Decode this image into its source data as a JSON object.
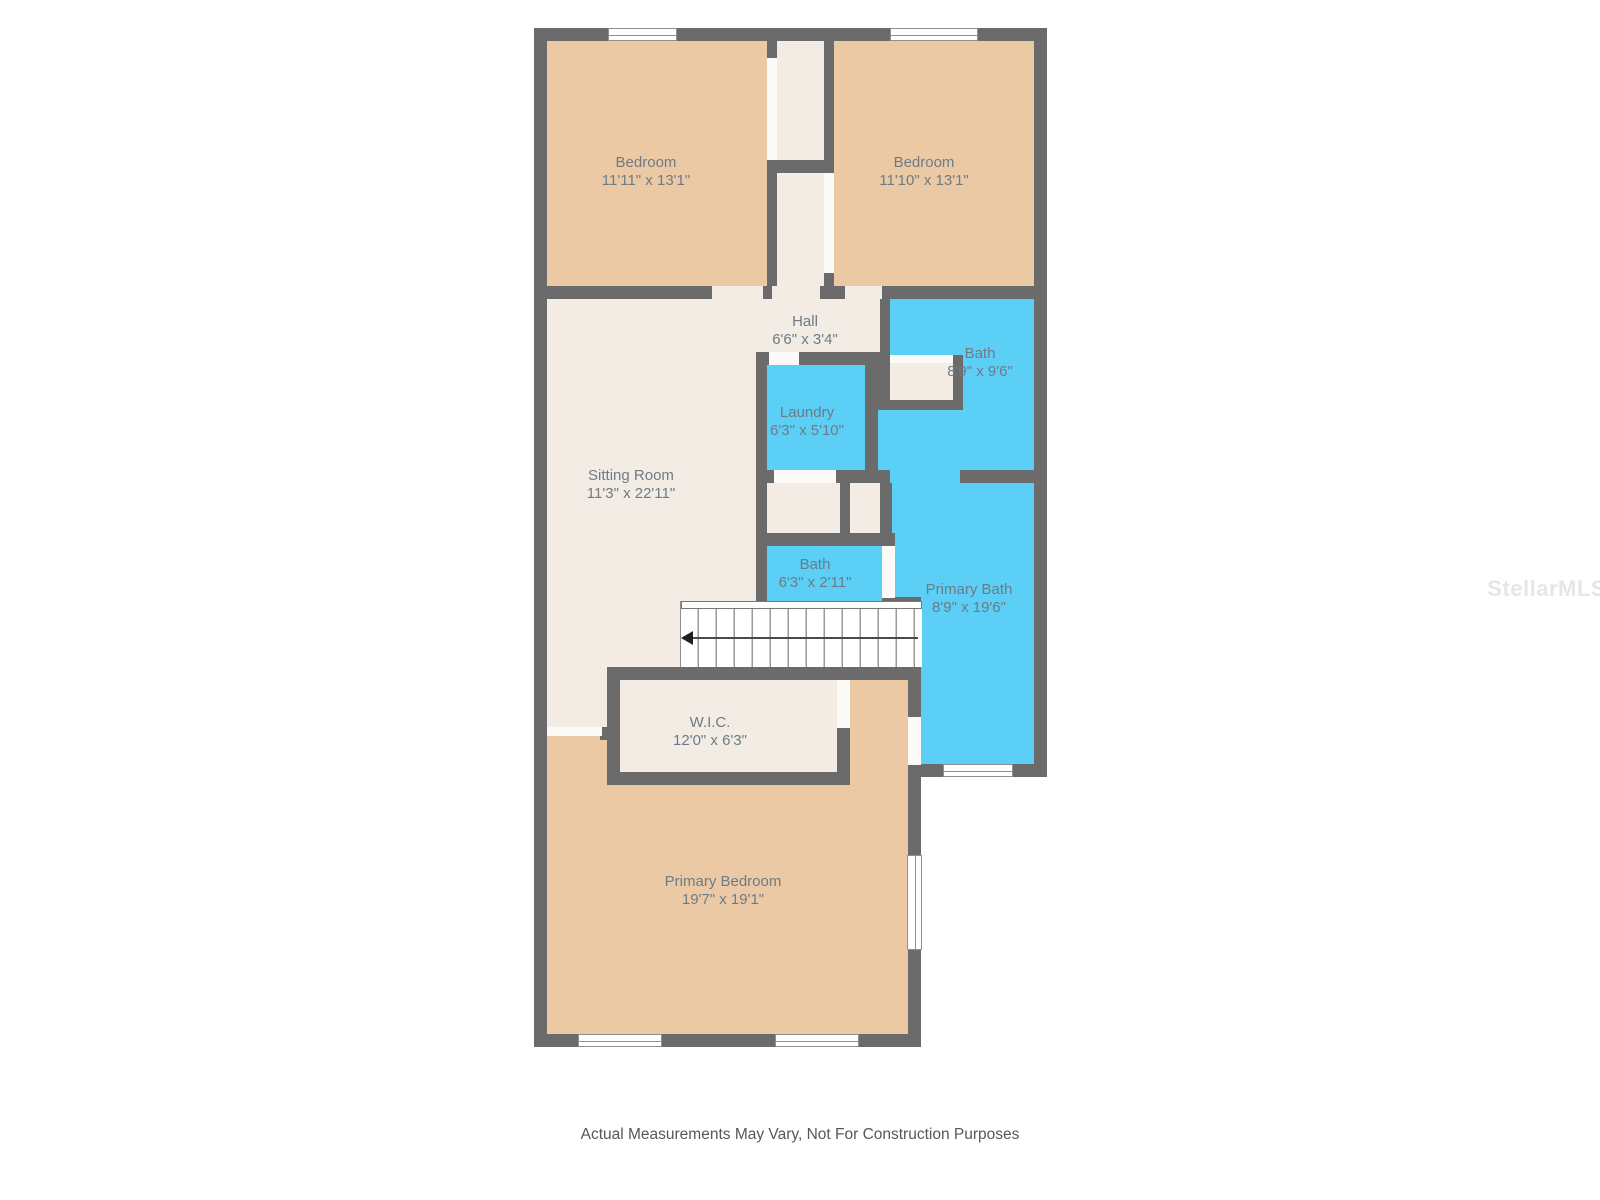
{
  "title": "Second floor plan",
  "watermark": "StellarMLS",
  "footer": {
    "disclaimer": "Actual Measurements May Vary, Not For Construction Purposes"
  },
  "colors": {
    "bedroom_fill": "#ecc9a5",
    "bath_fill": "#5ccff6",
    "hall_fill": "#f2ece4",
    "wall": "#6b6b6b",
    "label_text": "#6e7b85"
  },
  "stairs": {
    "arrow_direction": "left"
  },
  "rooms": [
    {
      "id": "bedroom-1",
      "name": "Bedroom",
      "dims": "11'11\" x 13'1\""
    },
    {
      "id": "bedroom-2",
      "name": "Bedroom",
      "dims": "11'10\" x 13'1\""
    },
    {
      "id": "hall",
      "name": "Hall",
      "dims": "6'6\" x 3'4\""
    },
    {
      "id": "bath",
      "name": "Bath",
      "dims": "8'9\" x 9'6\""
    },
    {
      "id": "laundry",
      "name": "Laundry",
      "dims": "6'3\" x 5'10\""
    },
    {
      "id": "sitting-room",
      "name": "Sitting Room",
      "dims": "11'3\" x 22'11\""
    },
    {
      "id": "bath-2",
      "name": "Bath",
      "dims": "6'3\" x 2'11\""
    },
    {
      "id": "primary-bath",
      "name": "Primary Bath",
      "dims": "8'9\" x 19'6\""
    },
    {
      "id": "wic",
      "name": "W.I.C.",
      "dims": "12'0\" x 6'3\""
    },
    {
      "id": "primary-bedroom",
      "name": "Primary Bedroom",
      "dims": "19'7\" x 19'1\""
    }
  ]
}
